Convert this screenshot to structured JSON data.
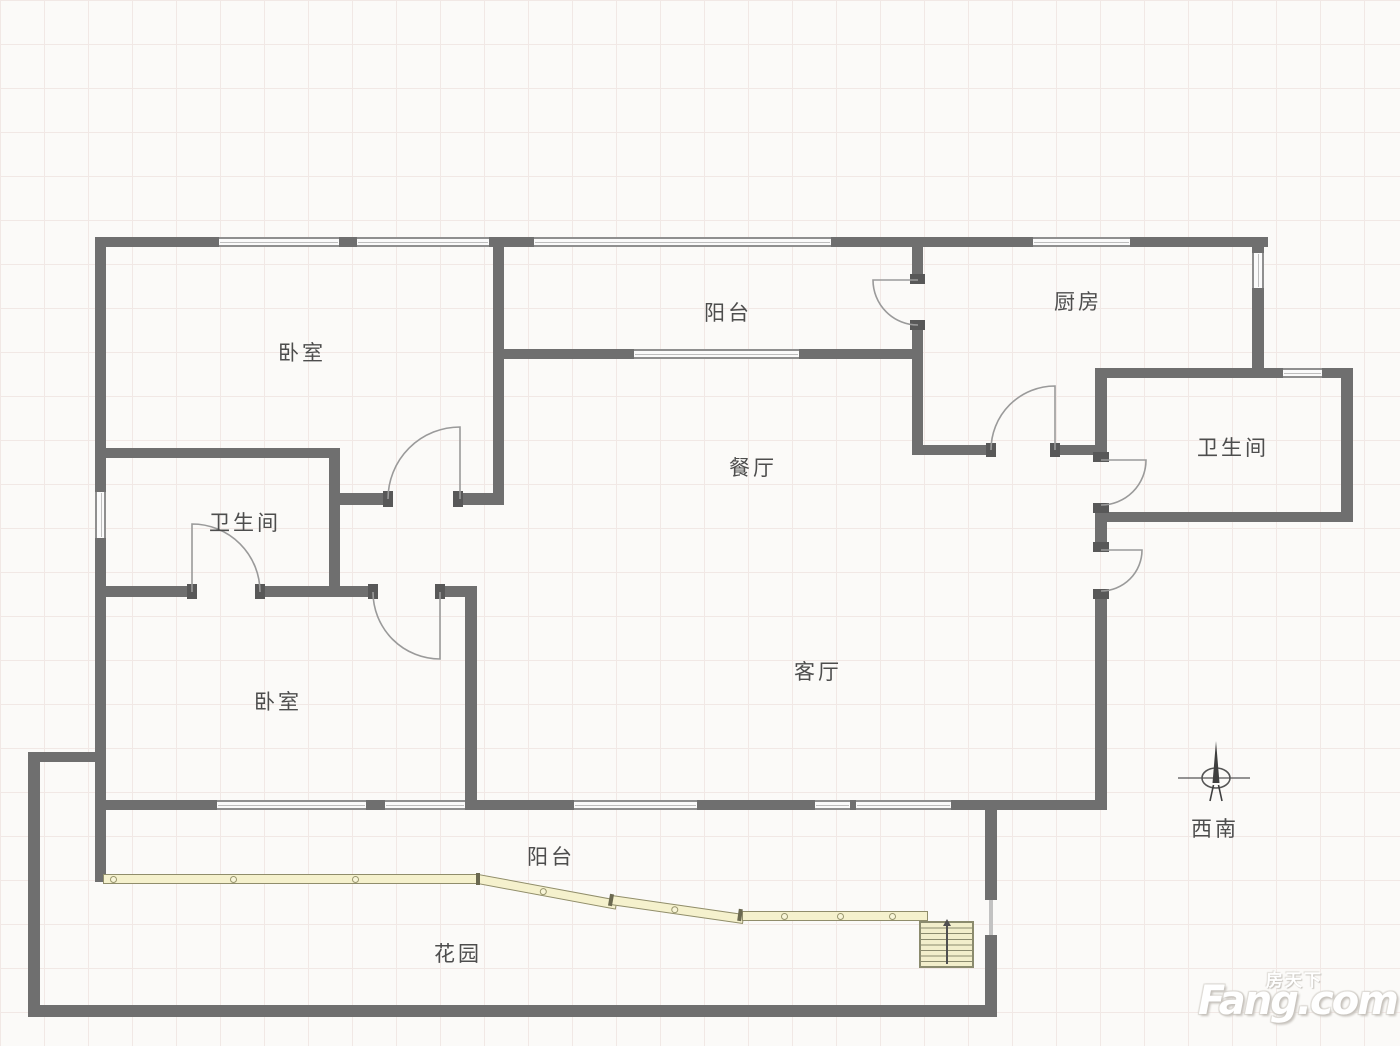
{
  "rooms": [
    {
      "id": "bedroom-top",
      "label": "卧室"
    },
    {
      "id": "balcony-top",
      "label": "阳台"
    },
    {
      "id": "kitchen",
      "label": "厨房"
    },
    {
      "id": "bathroom-right",
      "label": "卫生间"
    },
    {
      "id": "dining",
      "label": "餐厅"
    },
    {
      "id": "bathroom-left",
      "label": "卫生间"
    },
    {
      "id": "bedroom-bottom",
      "label": "卧室"
    },
    {
      "id": "living",
      "label": "客厅"
    },
    {
      "id": "balcony-bottom",
      "label": "阳台"
    },
    {
      "id": "garden",
      "label": "花园"
    }
  ],
  "compass": {
    "direction_label": "西南"
  },
  "watermark": {
    "brand_cn": "房天下",
    "brand_en": "Fang.com"
  },
  "colors": {
    "wall": "#6f6f6f",
    "background": "#fbfaf8",
    "grid_line": "#f1e8e5",
    "railing_fill": "#f5f1cd",
    "railing_border": "#908d6b",
    "label_text": "#4d4d4d",
    "door_arc": "#9a9a9a"
  }
}
